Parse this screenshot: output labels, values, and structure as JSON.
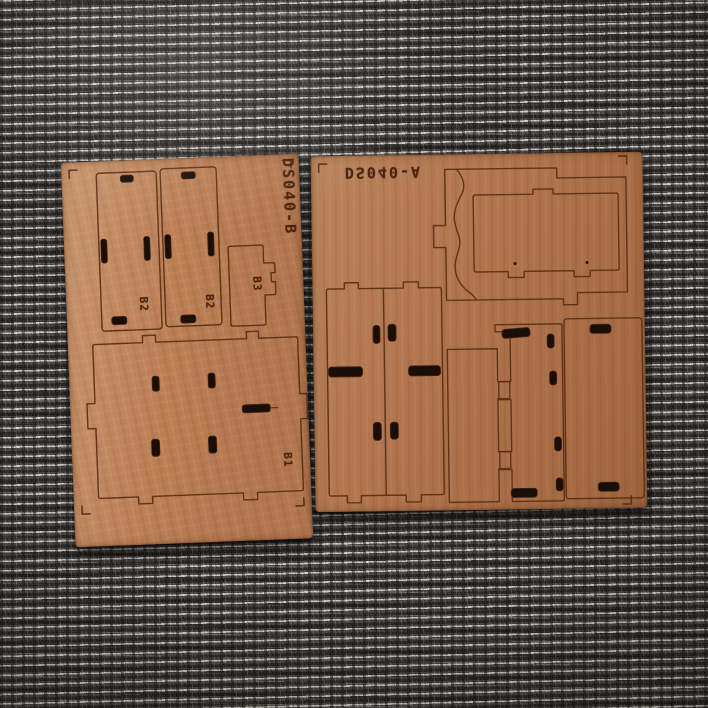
{
  "scene": {
    "alt": "Two laser-cut plywood model-kit sheets with engraved part outlines lying on gray ribbed fabric"
  },
  "sheets": {
    "left": {
      "label": "DS040-B",
      "parts": [
        {
          "label": "B2"
        },
        {
          "label": "B2"
        },
        {
          "label": "B3"
        },
        {
          "label": "B1"
        }
      ]
    },
    "right": {
      "label": "DS040-A",
      "parts": []
    }
  },
  "colors": {
    "wood_left": "#bb7f56",
    "wood_right": "#b0744c",
    "engrave_line": "#5c2e15",
    "slot_cut": "#1a0f08",
    "label_text": "#4a2410",
    "fabric_base": "#4a4846",
    "fabric_stripe": "#d8d4ca"
  }
}
